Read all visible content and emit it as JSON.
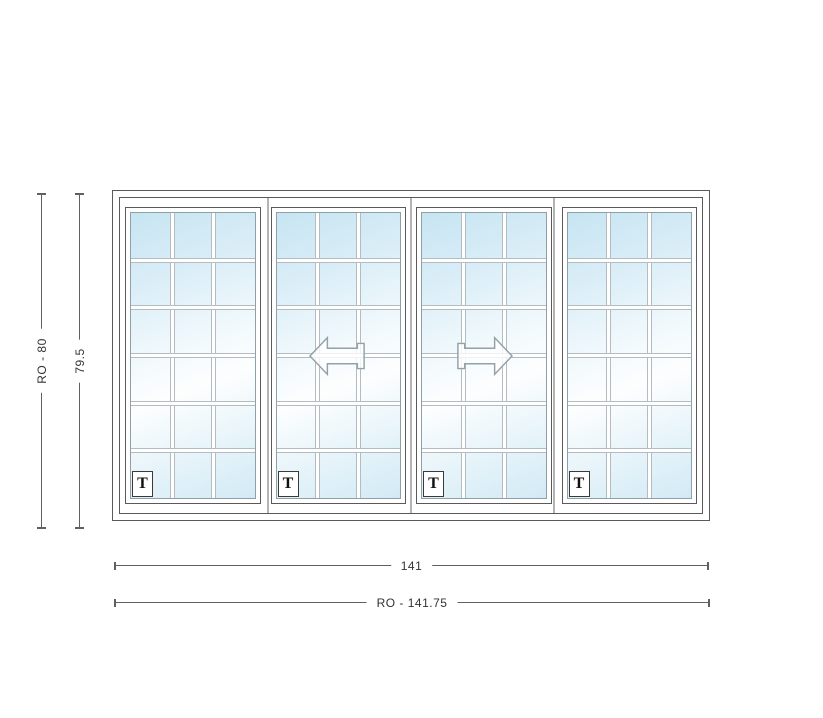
{
  "drawing": {
    "title": "4-panel sliding patio door elevation",
    "dimensions": {
      "height_ro": "RO - 80",
      "height": "79.5",
      "width": "141",
      "width_ro": "RO - 141.75"
    },
    "panels": [
      {
        "id": "panel-1",
        "label": "T",
        "operation": "fixed"
      },
      {
        "id": "panel-2",
        "label": "T",
        "operation": "slides-left"
      },
      {
        "id": "panel-3",
        "label": "T",
        "operation": "slides-right"
      },
      {
        "id": "panel-4",
        "label": "T",
        "operation": "fixed"
      }
    ],
    "grid": {
      "columns": 3,
      "rows": 6
    },
    "colors": {
      "glass_blue": "#c6e5f2",
      "glass_white": "#fdfefe",
      "frame_line": "#5a5a5a",
      "muntin_edge": "#b3bcc1",
      "dim_line": "#606060",
      "arrow_outline": "#93a1a8"
    }
  }
}
